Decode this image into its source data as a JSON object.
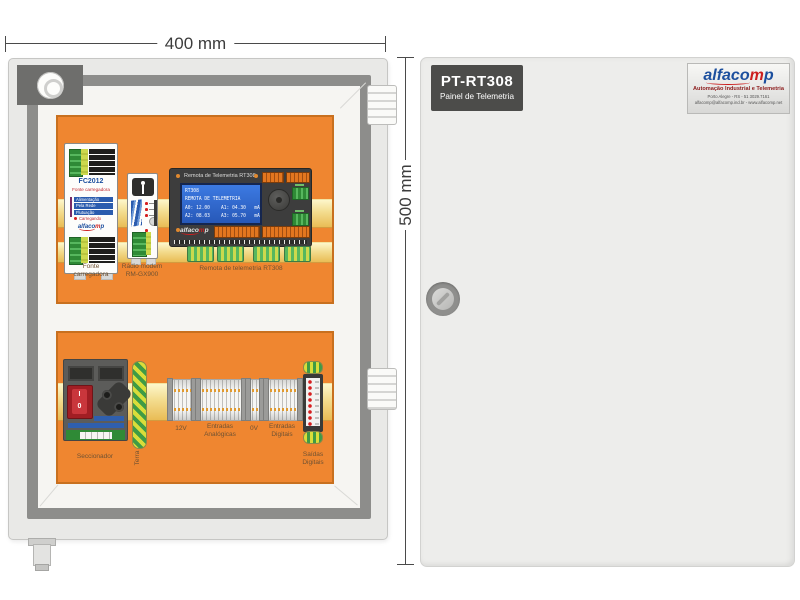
{
  "dimensions": {
    "width_label": "400 mm",
    "height_label": "500 mm"
  },
  "brand": {
    "part1": "alfaco",
    "part2": "m",
    "part3": "p"
  },
  "door": {
    "nameplate": {
      "title": "PT-RT308",
      "subtitle": "Painel de Telemetria"
    },
    "logo": {
      "tagline": "Automação Industrial e Telemetria",
      "address": "Porto Alegre - RS - 51 3029.7161",
      "contact": "alfacomp@alfacomp.ind.br - www.alfacomp.net"
    }
  },
  "interior": {
    "fonte": {
      "model": "FC2012",
      "type_label": "Fonte carregadora",
      "led_labels": [
        "Alimentação",
        "Pela Rede",
        "Flutuação",
        "Carregando"
      ],
      "caption_line1": "Fonte",
      "caption_line2": "carregadora"
    },
    "radio": {
      "caption_line1": "Rádio modem",
      "caption_line2": "RM-GX900"
    },
    "rt308": {
      "header": "Remota de Telemetria RT308",
      "lcd_line1": "RT308",
      "lcd_line2": "REMOTA DE TELEMETRIA",
      "lcd_line3": "A0: 12.00    A1: 04.30   mA",
      "lcd_line4": "A2: 08.03    A3: 05.70   mA",
      "caption": "Remota de telemetria RT308"
    },
    "seccionador": {
      "caption": "Seccionador",
      "switch_on": "I",
      "switch_off": "0"
    },
    "terra": {
      "caption": "Terra"
    },
    "rail_labels": {
      "v12": "12V",
      "analog_line1": "Entradas",
      "analog_line2": "Analógicas",
      "v0": "0V",
      "digital_line1": "Entradas",
      "digital_line2": "Digitais",
      "saidas_line1": "Saídas",
      "saidas_line2": "Digitais"
    }
  }
}
